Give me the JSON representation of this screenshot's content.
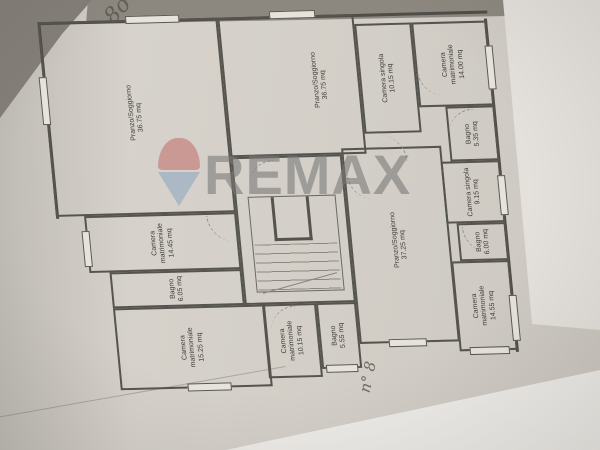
{
  "document_type": "floor-plan-photo",
  "watermark": {
    "text": "REMAX",
    "icon": "remax-balloon",
    "balloon_red": "#c4716e",
    "balloon_blue": "#8fa6bf",
    "text_gray": "#787876"
  },
  "annotations": {
    "top_left": "8o",
    "bottom_right": "n° 8"
  },
  "plan": {
    "wall_color": "#56544e",
    "paper_color": "#d5d1ca",
    "rooms": [
      {
        "name": "Pranzo/Soggiorno",
        "area": "36.75 mq"
      },
      {
        "name": "Camera matrimoniale",
        "area": "14.45 mq"
      },
      {
        "name": "Bagno",
        "area": "6.05 mq"
      },
      {
        "name": "Camera matrimoniale",
        "area": "15.25 mq"
      },
      {
        "name": "Pranzo/Soggiorno",
        "area": "36.75 mq"
      },
      {
        "name": "Camera matrimoniale",
        "area": "10.15 mq"
      },
      {
        "name": "Bagno",
        "area": "5.55 mq"
      },
      {
        "name": "Camera singola",
        "area": "10.15 mq"
      },
      {
        "name": "Pranzo/Soggiorno",
        "area": "37.25 mq"
      },
      {
        "name": "Camera matrimoniale",
        "area": "14.00 mq"
      },
      {
        "name": "Bagno",
        "area": "5.35 mq"
      },
      {
        "name": "Camera singola",
        "area": "9.15 mq"
      },
      {
        "name": "Bagno",
        "area": "6.00 mq"
      },
      {
        "name": "Camera matrimoniale",
        "area": "14.55 mq"
      }
    ]
  }
}
